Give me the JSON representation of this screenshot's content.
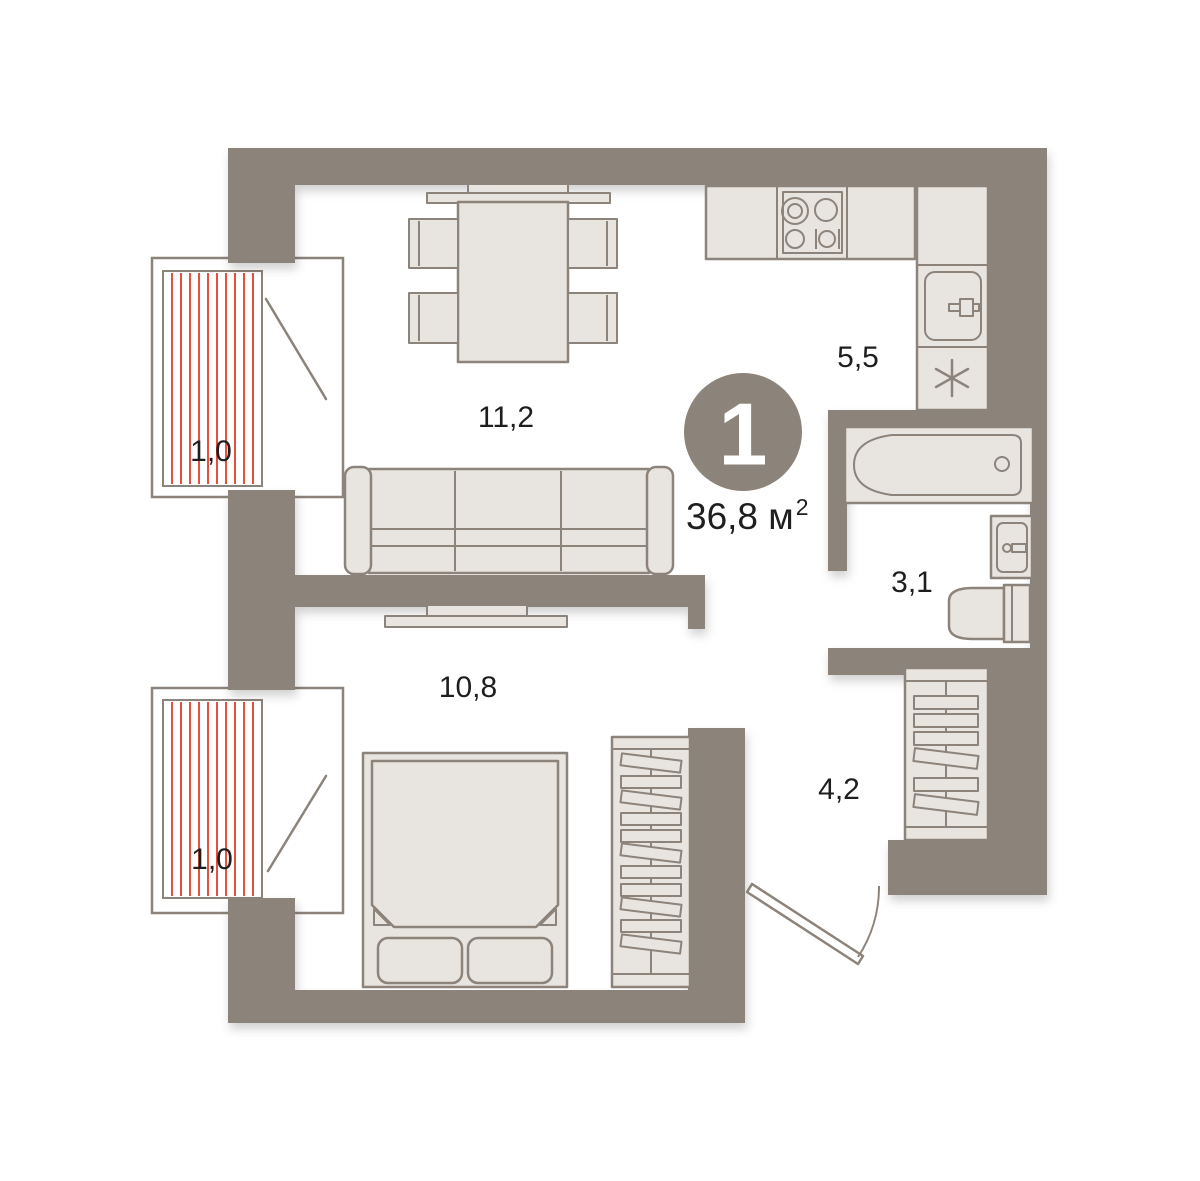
{
  "apartment": {
    "rooms_badge": "1",
    "total_area_value": "36,8",
    "total_area_unit": " м",
    "total_area_superscript": "2"
  },
  "rooms": [
    {
      "name": "living-room",
      "area": "11,2"
    },
    {
      "name": "bedroom",
      "area": "10,8"
    },
    {
      "name": "kitchen",
      "area": "5,5"
    },
    {
      "name": "bathroom",
      "area": "3,1"
    },
    {
      "name": "hallway",
      "area": "4,2"
    },
    {
      "name": "balcony-upper",
      "area": "1,0"
    },
    {
      "name": "balcony-lower",
      "area": "1,0"
    }
  ],
  "colors": {
    "wall": "#8c837a",
    "furn": "#e8e5e0",
    "outline": "#8c837a",
    "hatch": "#e6503c",
    "label": "#1e1e1e",
    "badge_text": "#ffffff",
    "bg": "#ffffff"
  }
}
